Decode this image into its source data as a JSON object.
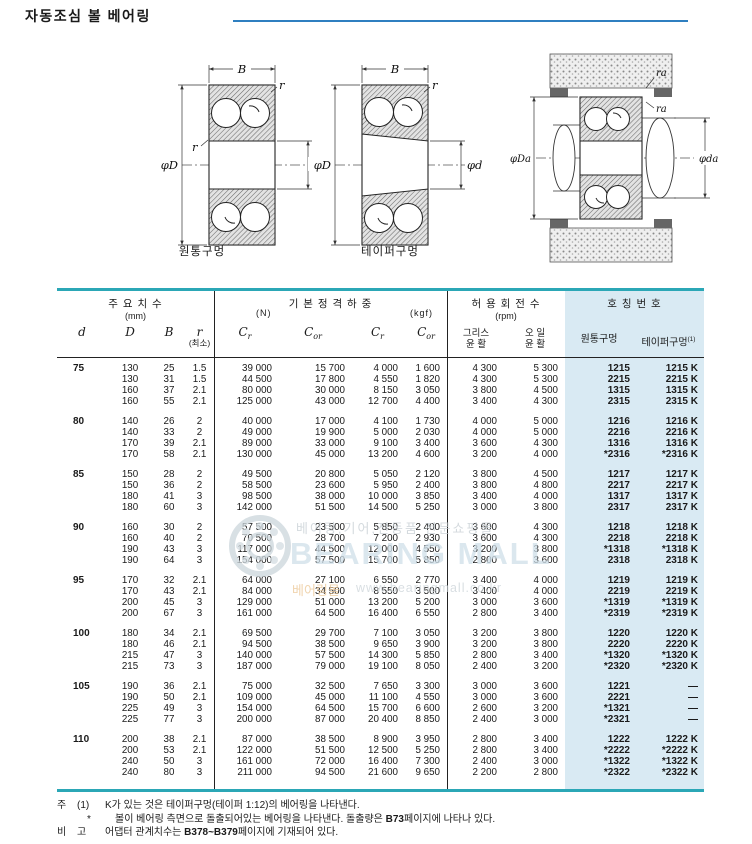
{
  "page": {
    "title": "자동조심 볼 베어링"
  },
  "diagrams": {
    "caption_cyl": "원통구멍",
    "caption_taper": "테이퍼구멍",
    "labels": {
      "B": "B",
      "r": "r",
      "phiD": "φD",
      "phid": "φd",
      "ra": "ra",
      "phiDa": "φDa",
      "phida": "φda"
    }
  },
  "table": {
    "header": {
      "dim_title": "주 요 치 수",
      "dim_unit": "(mm)",
      "load_title": "기 본 정 격 하 중",
      "load_unit_n": "(N)",
      "load_unit_kgf": "(kgf)",
      "speed_title": "허 용 회 전 수",
      "speed_unit": "(rpm)",
      "number_title": "호 칭 번 호",
      "col_d": "d",
      "col_D": "D",
      "col_B": "B",
      "col_r": "r",
      "col_r_sub": "(최소)",
      "c_sym": "C",
      "c_sub_r": "r",
      "c_sub_or": "or",
      "col_grease_1": "그리스",
      "col_grease_2": "윤 활",
      "col_oil_1": "오 일",
      "col_oil_2": "윤 활",
      "col_cyl": "원통구멍",
      "col_taper": "테이퍼구멍",
      "col_taper_sup": "(1)"
    },
    "groups": [
      {
        "d": "75",
        "rows": [
          [
            "130",
            "25",
            "1.5",
            "39 000",
            "15 700",
            "4 000",
            "1 600",
            "4 300",
            "5 300",
            "1215",
            "1215 K"
          ],
          [
            "130",
            "31",
            "1.5",
            "44 500",
            "17 800",
            "4 550",
            "1 820",
            "4 300",
            "5 300",
            "2215",
            "2215 K"
          ],
          [
            "160",
            "37",
            "2.1",
            "80 000",
            "30 000",
            "8 150",
            "3 050",
            "3 800",
            "4 500",
            "1315",
            "1315 K"
          ],
          [
            "160",
            "55",
            "2.1",
            "125 000",
            "43 000",
            "12 700",
            "4 400",
            "3 400",
            "4 300",
            "2315",
            "2315 K"
          ]
        ]
      },
      {
        "d": "80",
        "rows": [
          [
            "140",
            "26",
            "2",
            "40 000",
            "17 000",
            "4 100",
            "1 730",
            "4 000",
            "5 000",
            "1216",
            "1216 K"
          ],
          [
            "140",
            "33",
            "2",
            "49 000",
            "19 900",
            "5 000",
            "2 030",
            "4 000",
            "5 000",
            "2216",
            "2216 K"
          ],
          [
            "170",
            "39",
            "2.1",
            "89 000",
            "33 000",
            "9 100",
            "3 400",
            "3 600",
            "4 300",
            "1316",
            "1316 K"
          ],
          [
            "170",
            "58",
            "2.1",
            "130 000",
            "45 000",
            "13 200",
            "4 600",
            "3 200",
            "4 000",
            "*2316",
            "*2316 K"
          ]
        ]
      },
      {
        "d": "85",
        "rows": [
          [
            "150",
            "28",
            "2",
            "49 500",
            "20 800",
            "5 050",
            "2 120",
            "3 800",
            "4 500",
            "1217",
            "1217 K"
          ],
          [
            "150",
            "36",
            "2",
            "58 500",
            "23 600",
            "5 950",
            "2 400",
            "3 800",
            "4 800",
            "2217",
            "2217 K"
          ],
          [
            "180",
            "41",
            "3",
            "98 500",
            "38 000",
            "10 000",
            "3 850",
            "3 400",
            "4 000",
            "1317",
            "1317 K"
          ],
          [
            "180",
            "60",
            "3",
            "142 000",
            "51 500",
            "14 500",
            "5 250",
            "3 000",
            "3 800",
            "2317",
            "2317 K"
          ]
        ]
      },
      {
        "d": "90",
        "rows": [
          [
            "160",
            "30",
            "2",
            "57 500",
            "23 500",
            "5 850",
            "2 400",
            "3 600",
            "4 300",
            "1218",
            "1218 K"
          ],
          [
            "160",
            "40",
            "2",
            "70 500",
            "28 700",
            "7 200",
            "2 930",
            "3 600",
            "4 300",
            "2218",
            "2218 K"
          ],
          [
            "190",
            "43",
            "3",
            "117 000",
            "44 500",
            "12 000",
            "4 550",
            "3 200",
            "3 800",
            "*1318",
            "*1318 K"
          ],
          [
            "190",
            "64",
            "3",
            "154 000",
            "57 500",
            "15 700",
            "5 850",
            "2 800",
            "3 600",
            "2318",
            "2318 K"
          ]
        ]
      },
      {
        "d": "95",
        "rows": [
          [
            "170",
            "32",
            "2.1",
            "64 000",
            "27 100",
            "6 550",
            "2 770",
            "3 400",
            "4 000",
            "1219",
            "1219 K"
          ],
          [
            "170",
            "43",
            "2.1",
            "84 000",
            "34 500",
            "8 550",
            "3 500",
            "3 400",
            "4 000",
            "2219",
            "2219 K"
          ],
          [
            "200",
            "45",
            "3",
            "129 000",
            "51 000",
            "13 200",
            "5 200",
            "3 000",
            "3 600",
            "*1319",
            "*1319 K"
          ],
          [
            "200",
            "67",
            "3",
            "161 000",
            "64 500",
            "16 400",
            "6 550",
            "2 800",
            "3 400",
            "*2319",
            "*2319 K"
          ]
        ]
      },
      {
        "d": "100",
        "rows": [
          [
            "180",
            "34",
            "2.1",
            "69 500",
            "29 700",
            "7 100",
            "3 050",
            "3 200",
            "3 800",
            "1220",
            "1220 K"
          ],
          [
            "180",
            "46",
            "2.1",
            "94 500",
            "38 500",
            "9 650",
            "3 900",
            "3 200",
            "3 800",
            "2220",
            "2220 K"
          ],
          [
            "215",
            "47",
            "3",
            "140 000",
            "57 500",
            "14 300",
            "5 850",
            "2 800",
            "3 400",
            "*1320",
            "*1320 K"
          ],
          [
            "215",
            "73",
            "3",
            "187 000",
            "79 000",
            "19 100",
            "8 050",
            "2 400",
            "3 200",
            "*2320",
            "*2320 K"
          ]
        ]
      },
      {
        "d": "105",
        "rows": [
          [
            "190",
            "36",
            "2.1",
            "75 000",
            "32 500",
            "7 650",
            "3 300",
            "3 000",
            "3 600",
            "1221",
            "—"
          ],
          [
            "190",
            "50",
            "2.1",
            "109 000",
            "45 000",
            "11 100",
            "4 550",
            "3 000",
            "3 600",
            "2221",
            "—"
          ],
          [
            "225",
            "49",
            "3",
            "154 000",
            "64 500",
            "15 700",
            "6 600",
            "2 600",
            "3 200",
            "*1321",
            "—"
          ],
          [
            "225",
            "77",
            "3",
            "200 000",
            "87 000",
            "20 400",
            "8 850",
            "2 400",
            "3 000",
            "*2321",
            "—"
          ]
        ]
      },
      {
        "d": "110",
        "rows": [
          [
            "200",
            "38",
            "2.1",
            "87 000",
            "38 500",
            "8 900",
            "3 950",
            "2 800",
            "3 400",
            "1222",
            "1222 K"
          ],
          [
            "200",
            "53",
            "2.1",
            "122 000",
            "51 500",
            "12 500",
            "5 250",
            "2 800",
            "3 400",
            "*2222",
            "*2222 K"
          ],
          [
            "240",
            "50",
            "3",
            "161 000",
            "72 000",
            "16 400",
            "7 300",
            "2 400",
            "3 000",
            "*1322",
            "*1322 K"
          ],
          [
            "240",
            "80",
            "3",
            "211 000",
            "94 500",
            "21 600",
            "9 650",
            "2 200",
            "2 800",
            "*2322",
            "*2322 K"
          ]
        ]
      }
    ]
  },
  "watermark": {
    "line1": "베어링,기어,전동품 전문쇼핑몰",
    "brand": "BEARING MALL",
    "line2": "베어링몰",
    "url": "www.bearingmall.co.kr"
  },
  "notes": {
    "label_ju": "주",
    "mark_1": "(1)",
    "text1": "K가 있는 것은 테이퍼구멍(테이퍼 1:12)의 베어링을 나타낸다.",
    "mark_star": "*",
    "text2_pre": "볼이 베어링 측면으로 돌출되어있는 베어링을 나타낸다. 돌출량은 ",
    "text2_bold": "B73",
    "text2_post": "페이지에 나타나 있다.",
    "label_bi": "비",
    "label_go": "고",
    "text3_pre": "어댑터 관계치수는 ",
    "text3_bold": "B378~B379",
    "text3_post": "페이지에 기재되어 있다."
  }
}
